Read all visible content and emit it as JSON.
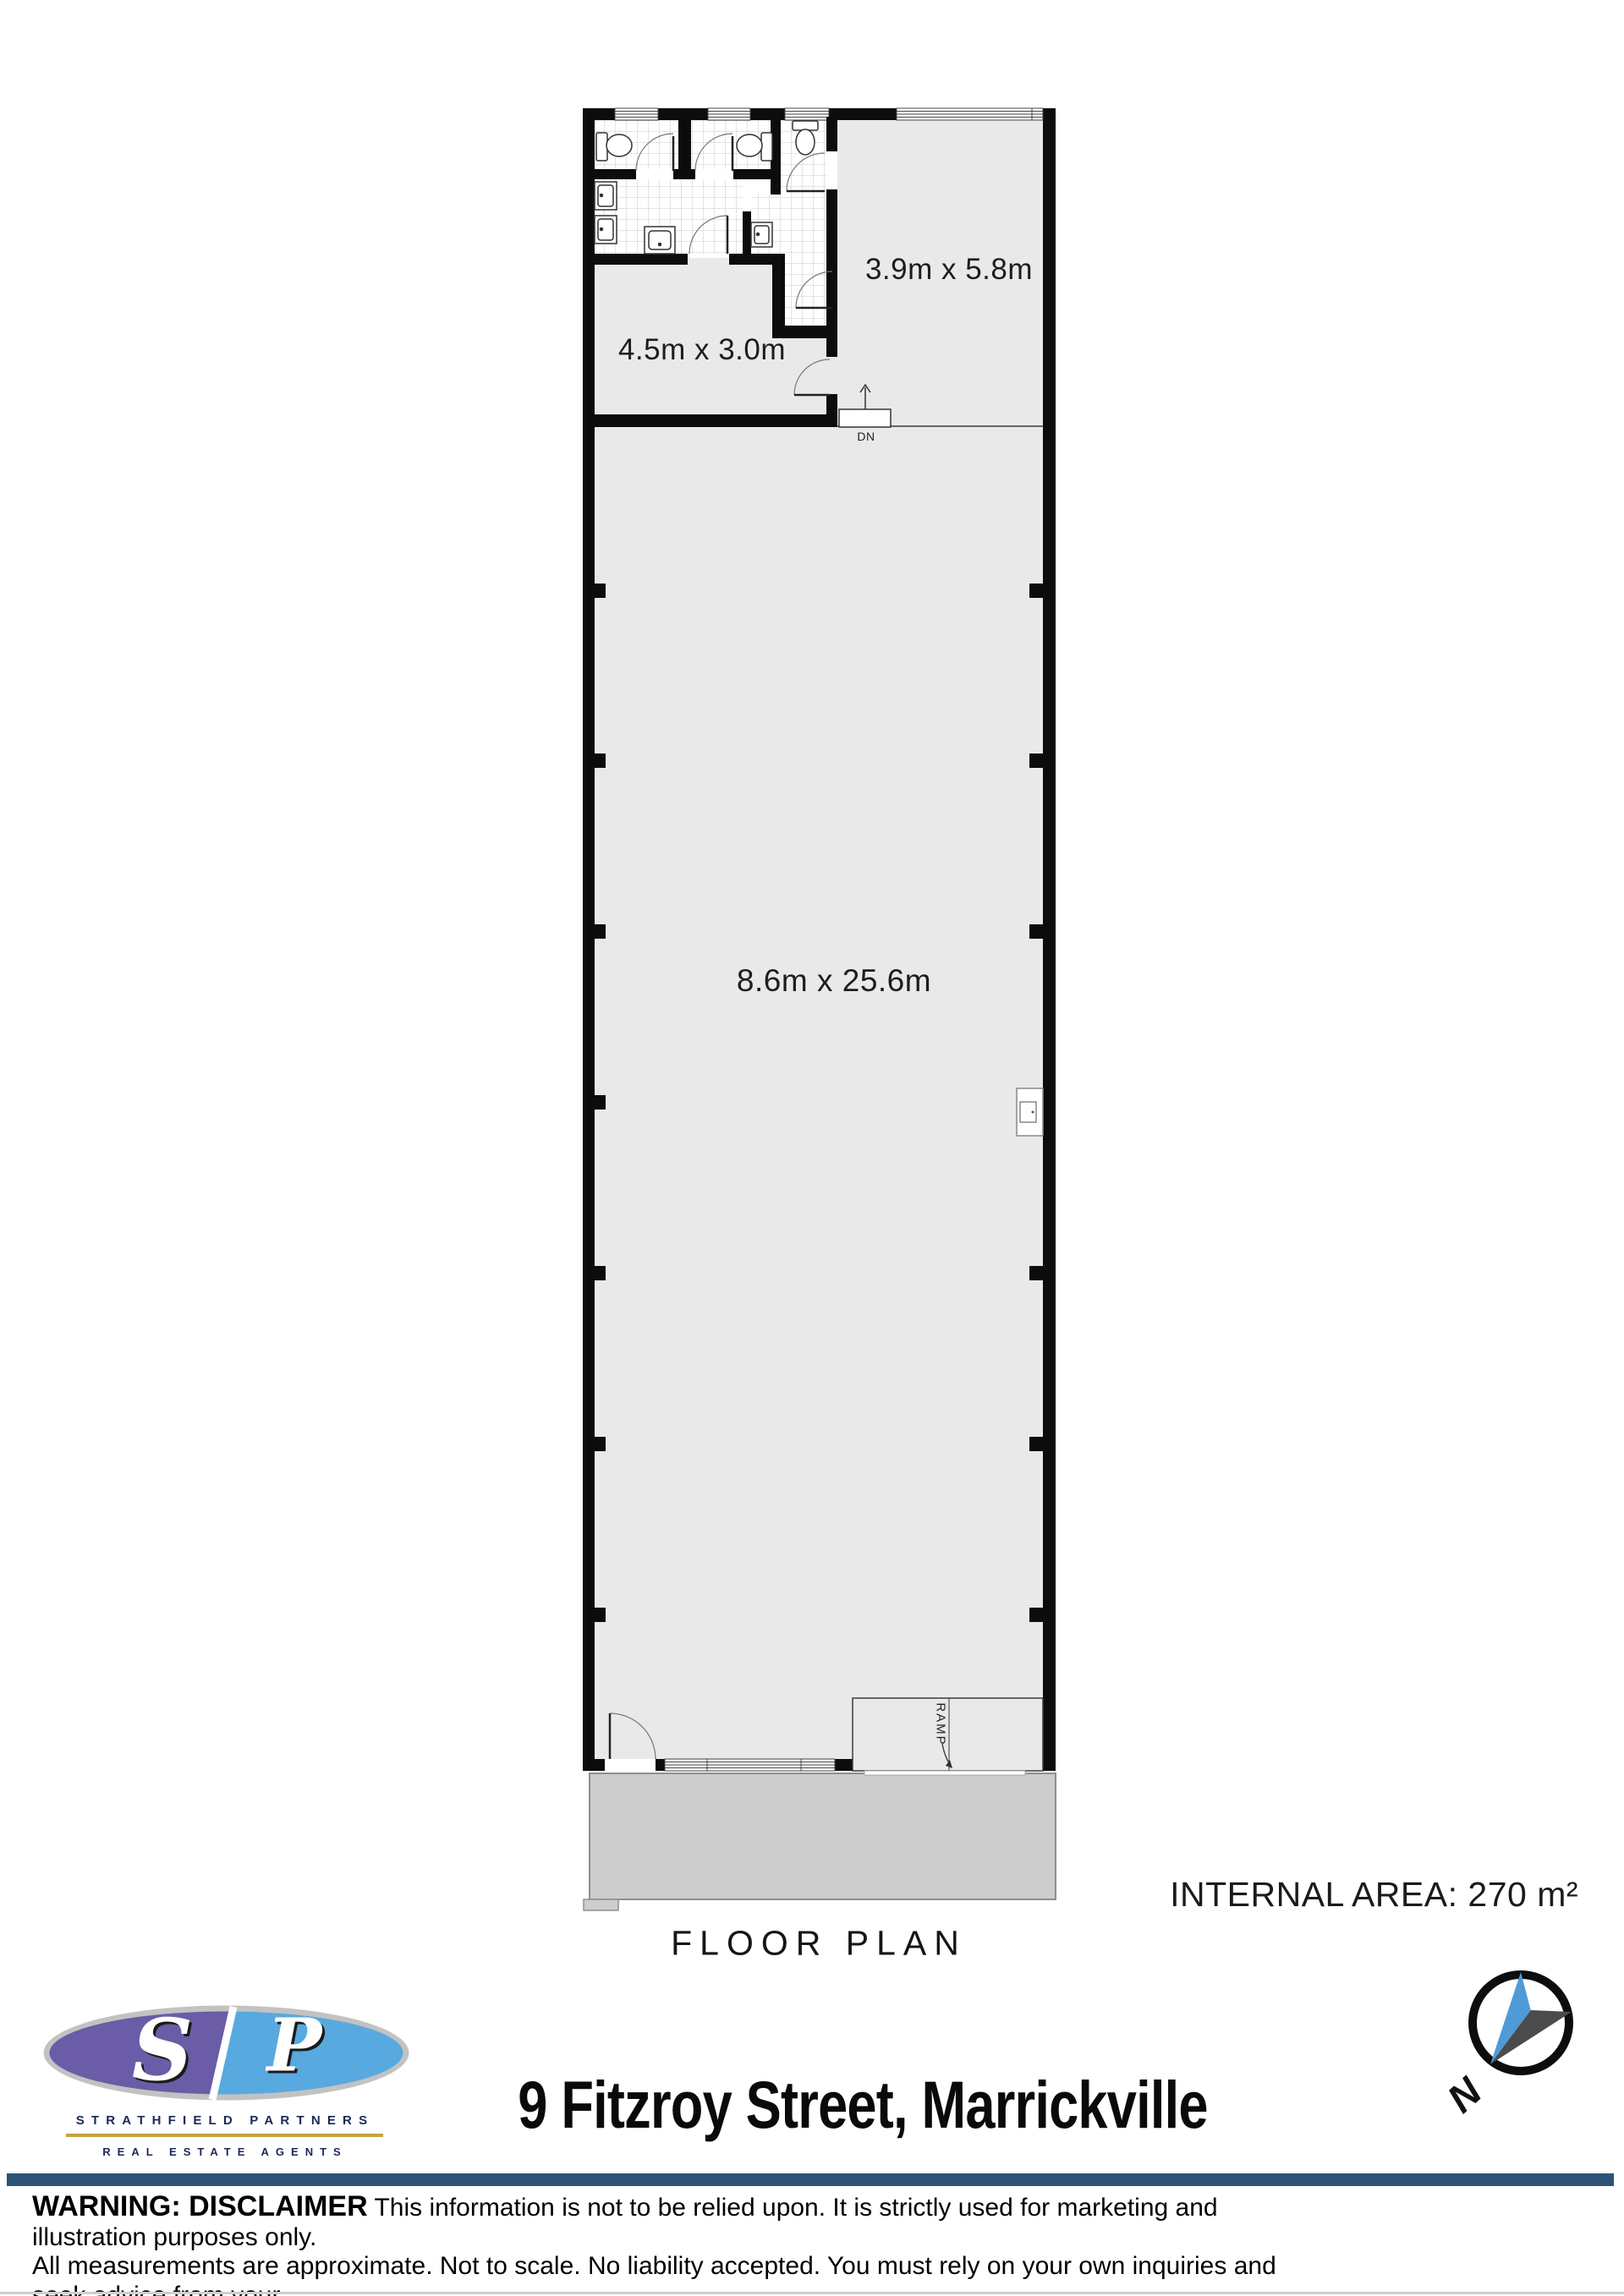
{
  "plan": {
    "rooms": [
      {
        "id": "room-top-right",
        "label": "3.9m x 5.8m"
      },
      {
        "id": "room-top-left",
        "label": "4.5m x 3.0m"
      },
      {
        "id": "room-main",
        "label": "8.6m x 25.6m"
      }
    ],
    "stair_label": "DN",
    "ramp_label": "RAMP",
    "title": "FLOOR PLAN",
    "internal_area": "INTERNAL AREA: 270 m²"
  },
  "branding": {
    "logo_s": "S",
    "logo_p": "P",
    "company": "STRATHFIELD PARTNERS",
    "tagline": "REAL ESTATE AGENTS"
  },
  "address": "9 Fitzroy Street, Marrickville",
  "compass_label": "N",
  "disclaimer": {
    "lead": "WARNING: DISCLAIMER",
    "line1": "This information is not to be relied upon. It is strictly used for marketing and illustration purposes only.",
    "line2": "All measurements are approximate. Not to scale. No liability accepted. You must rely on your own inquiries and seek advice from your",
    "line3": "solicitor."
  },
  "colors": {
    "room_fill": "#e9e9e9",
    "porch_fill": "#cdcdcd",
    "wall": "#0c0c0c",
    "logo_purple": "#6a5ca6",
    "logo_blue": "#58a9df",
    "brand_navy": "#1b2859",
    "brand_gold": "#c5a33e",
    "footer_bar_blue": "#2e5377",
    "needle_blue": "#4f9bd8",
    "needle_gray": "#4b4b4b"
  }
}
